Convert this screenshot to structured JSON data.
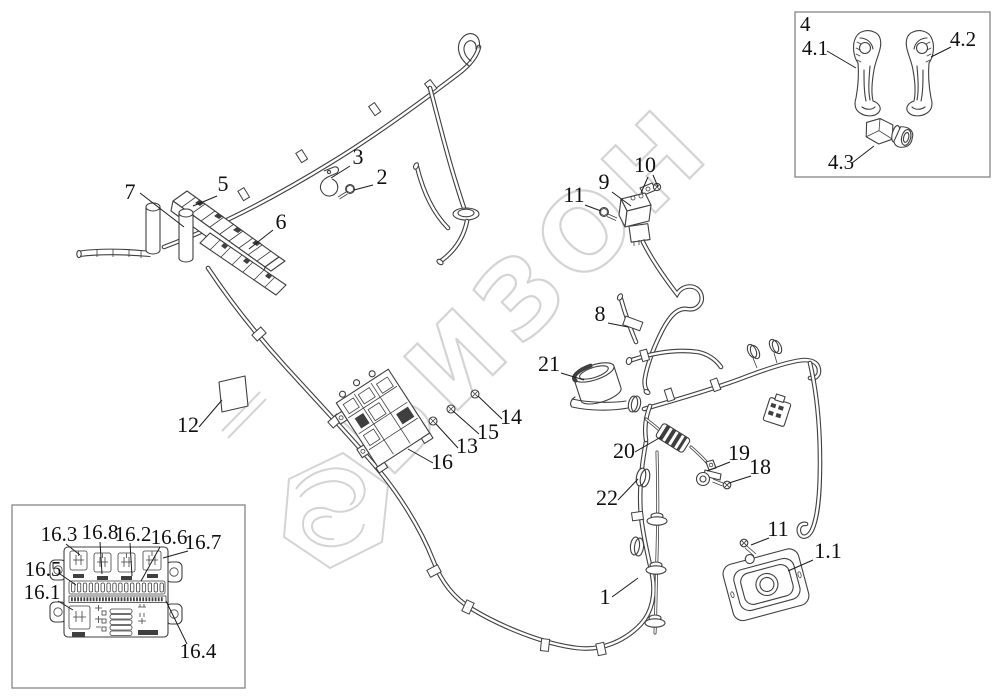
{
  "watermark": {
    "text": "БИЗОН",
    "color": "#d4d4d4"
  },
  "colors": {
    "line_art": "#3f3f3f",
    "label_text": "#101010",
    "inset_border": "#858585",
    "background": "#ffffff"
  },
  "callouts": {
    "c1": "1",
    "c1_1": "1.1",
    "c2": "2",
    "c3": "3",
    "c5": "5",
    "c6": "6",
    "c7": "7",
    "c8": "8",
    "c9": "9",
    "c10": "10",
    "c11": "11",
    "c11b": "11",
    "c12": "12",
    "c13": "13",
    "c14": "14",
    "c15": "15",
    "c16": "16",
    "c18": "18",
    "c19": "19",
    "c20": "20",
    "c21": "21",
    "c22": "22"
  },
  "controls_inset": {
    "title": "4",
    "c4_1": "4.1",
    "c4_2": "4.2",
    "c4_3": "4.3"
  },
  "fusebox_inset": {
    "c16_1": "16.1",
    "c16_2": "16.2",
    "c16_3": "16.3",
    "c16_4": "16.4",
    "c16_5": "16.5",
    "c16_6": "16.6",
    "c16_7": "16.7",
    "c16_8": "16.8"
  }
}
